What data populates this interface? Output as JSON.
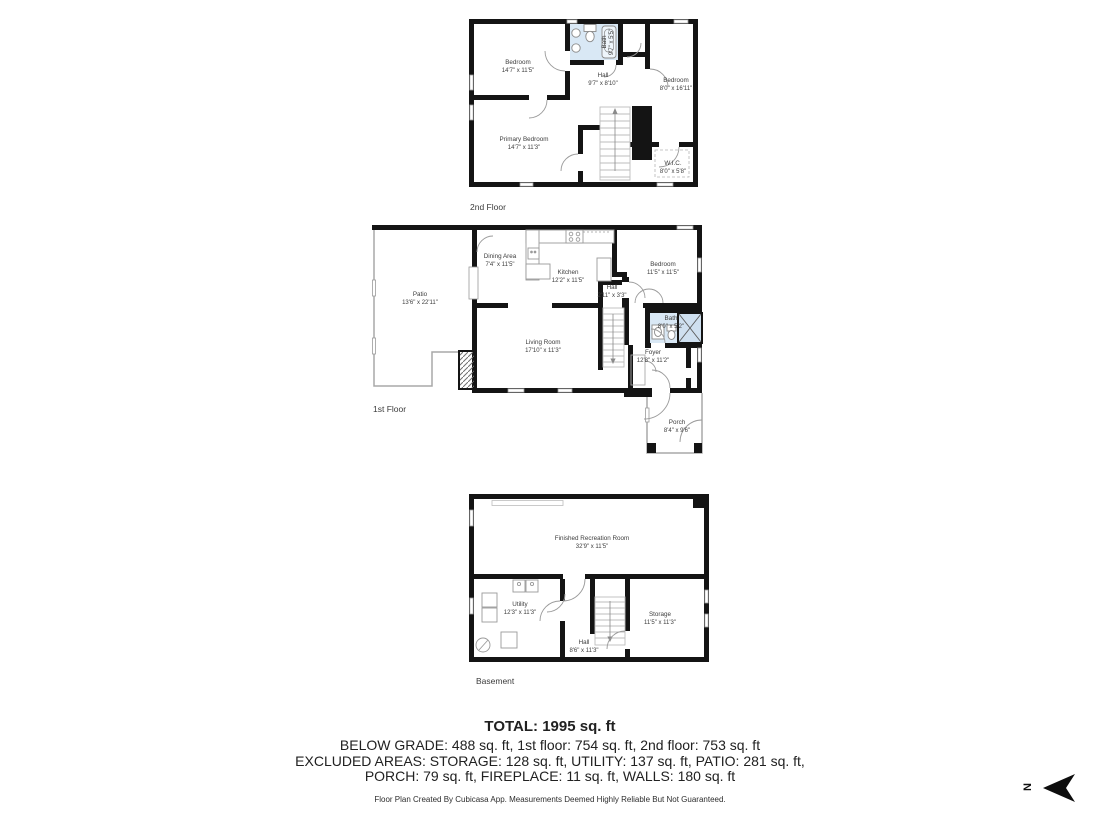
{
  "floors": {
    "second": {
      "label": "2nd Floor",
      "rooms": {
        "bedroom_left": {
          "name": "Bedroom",
          "dims": "14'7\" x 11'5\""
        },
        "bath": {
          "name": "Bath",
          "dims": "9'7\" x 5'5\""
        },
        "hall": {
          "name": "Hall",
          "dims": "9'7\" x 8'10\""
        },
        "bedroom_right": {
          "name": "Bedroom",
          "dims": "8'0\" x 16'11\""
        },
        "primary_bedroom": {
          "name": "Primary Bedroom",
          "dims": "14'7\" x 11'3\""
        },
        "wic": {
          "name": "W.I.C.",
          "dims": "8'0\" x 5'8\""
        }
      }
    },
    "first": {
      "label": "1st Floor",
      "rooms": {
        "patio": {
          "name": "Patio",
          "dims": "13'6\" x 22'11\""
        },
        "dining": {
          "name": "Dining Area",
          "dims": "7'4\" x 11'5\""
        },
        "kitchen": {
          "name": "Kitchen",
          "dims": "12'2\" x 11'5\""
        },
        "hall": {
          "name": "Hall",
          "dims": "2'11\" x 3'3\""
        },
        "bedroom": {
          "name": "Bedroom",
          "dims": "11'5\" x 11'5\""
        },
        "bath": {
          "name": "Bath",
          "dims": "8'0\" x 5'2\""
        },
        "living": {
          "name": "Living Room",
          "dims": "17'10\" x 11'3\""
        },
        "foyer": {
          "name": "Foyer",
          "dims": "12'8\" x 11'2\""
        },
        "porch": {
          "name": "Porch",
          "dims": "8'4\" x 9'6\""
        }
      }
    },
    "basement": {
      "label": "Basement",
      "rooms": {
        "rec_room": {
          "name": "Finished Recreation Room",
          "dims": "32'9\" x 11'5\""
        },
        "utility": {
          "name": "Utility",
          "dims": "12'3\" x 11'3\""
        },
        "hall": {
          "name": "Hall",
          "dims": "8'6\" x 11'3\""
        },
        "storage": {
          "name": "Storage",
          "dims": "11'5\" x 11'3\""
        }
      }
    }
  },
  "summary": {
    "total": "TOTAL: 1995 sq. ft",
    "line1": "BELOW GRADE: 488 sq. ft, 1st floor: 754 sq. ft, 2nd floor: 753 sq. ft",
    "line2": "EXCLUDED AREAS: STORAGE: 128 sq. ft, UTILITY: 137 sq. ft, PATIO: 281 sq. ft,",
    "line3": "PORCH: 79 sq. ft, FIREPLACE: 11 sq. ft, WALLS: 180 sq. ft",
    "disclaimer": "Floor Plan Created By Cubicasa App. Measurements Deemed Highly Reliable But Not Guaranteed."
  },
  "compass": {
    "letter": "N"
  },
  "colors": {
    "wall": "#141414",
    "bath_fill": "#d9e8f5",
    "label_text": "#3d3d3d"
  }
}
